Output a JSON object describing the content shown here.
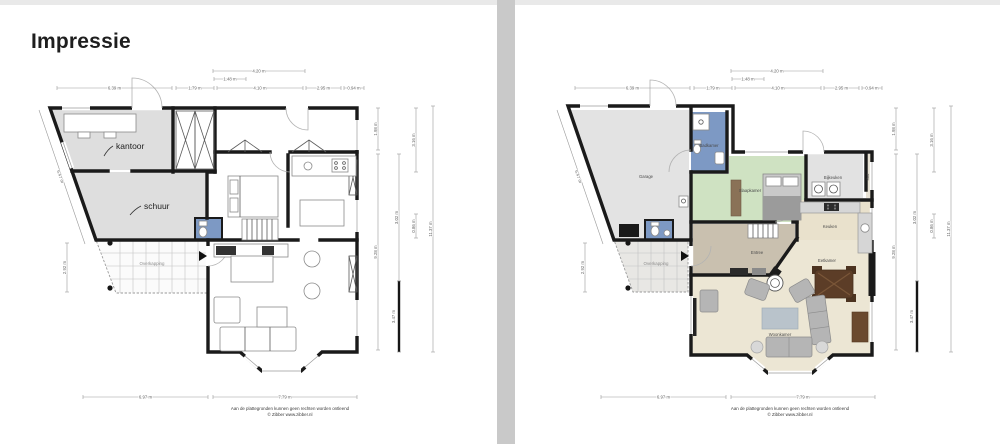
{
  "header": {
    "title": "Impressie"
  },
  "panels": {
    "left": {
      "rooms": {
        "kantoor": "kantoor",
        "schuur": "schuur",
        "overkapping": "Overkapping"
      }
    },
    "right": {
      "rooms": {
        "garage": "Garage",
        "badkamer": "Badkamer",
        "slaapkamer": "Slaapkamer",
        "bijkeuken": "Bijkeuken",
        "kast": "Kast",
        "keuken": "Keuken",
        "entree": "Entree",
        "eetkamer": "Eetkamer",
        "woonkamer": "Woonkamer",
        "overkapping": "Overkapping"
      }
    }
  },
  "dimensions": {
    "dim_420": "4.20 m",
    "dim_148": "1.48 m",
    "dim_639": "6.39 m",
    "dim_179": "1.79 m",
    "dim_410": "4.10 m",
    "dim_295": "2.95 m",
    "dim_094": "0.94 m",
    "dim_647": "6.47 m",
    "dim_292": "2.92 m",
    "dim_198": "1.98 m",
    "dim_928": "9.28 m",
    "dim_302": "3.02 m",
    "dim_347": "3.47 m",
    "dim_316": "3.16 m",
    "dim_086": "0.86 m",
    "dim_1137": "11.37 m",
    "dim_697": "6.97 m",
    "dim_779": "7.79 m"
  },
  "footer": {
    "disclaimer": "Aan de plattegronden kunnen geen rechten worden ontleend",
    "copyright": "© Zibber www.zibber.nl"
  },
  "colors": {
    "wall": "#1a1a1a",
    "divider": "#c9c9c9",
    "garage": "#e3e3e3",
    "badkamer": "#7d99c4",
    "slaapkamer": "#cfe2c2",
    "bijkeuken": "#e2e2e2",
    "kast": "#e8e2d4",
    "keuken": "#e9e1cc",
    "woonkamer": "#ece6d4",
    "entree": "#c9c0af",
    "kantoor": "#dedede",
    "schuur": "#dedede"
  }
}
